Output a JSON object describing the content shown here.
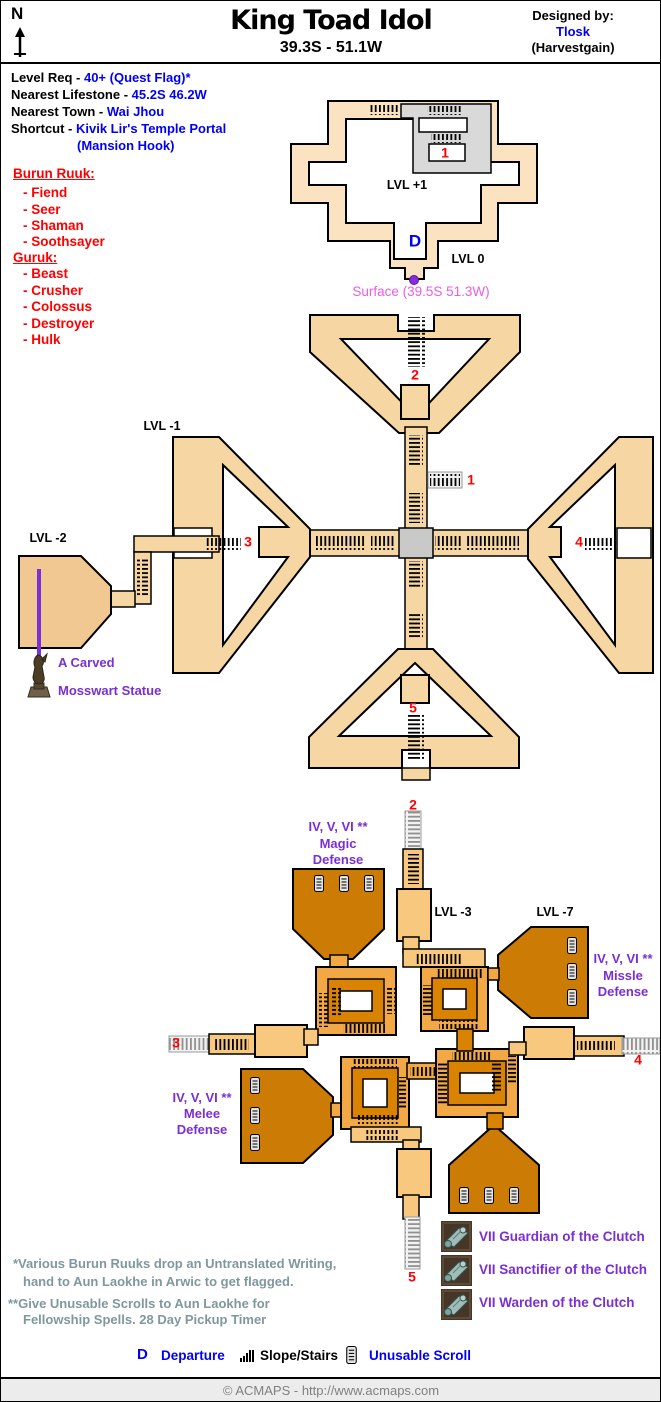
{
  "header": {
    "north": "N",
    "title": "King Toad Idol",
    "coords": "39.3S - 51.1W",
    "designed_by": "Designed by:",
    "designer": "Tlosk",
    "guild": "(Harvestgain)"
  },
  "info": {
    "lines": [
      {
        "label": "Level Req - ",
        "value": "40+ (Quest Flag)*"
      },
      {
        "label": "Nearest Lifestone - ",
        "value": "45.2S 46.2W"
      },
      {
        "label": "Nearest Town - ",
        "value": "Wai Jhou"
      },
      {
        "label": "Shortcut - ",
        "value": "Kivik Lir's Temple Portal"
      }
    ],
    "shortcut_line2": "(Mansion Hook)"
  },
  "creatures": {
    "burun": {
      "title": "Burun Ruuk:",
      "items": [
        "- Fiend",
        "- Seer",
        "- Shaman",
        "- Soothsayer"
      ]
    },
    "guruk": {
      "title": "Guruk:",
      "items": [
        "- Beast",
        "- Crusher",
        "- Colossus",
        "- Destroyer",
        "- Hulk"
      ]
    }
  },
  "levels": {
    "p1": "LVL +1",
    "zero": "LVL 0",
    "m1": "LVL -1",
    "m2": "LVL -2",
    "m3": "LVL -3",
    "m7": "LVL -7"
  },
  "markers": {
    "t1": "1",
    "m1": "1",
    "m2": "2",
    "m3": "3",
    "m4": "4",
    "m5": "5",
    "l2": "2",
    "l3": "3",
    "l4": "4",
    "l5": "5",
    "d": "D"
  },
  "surface": {
    "label": "Surface (39.5S 51.3W)"
  },
  "statue": {
    "line1": "A Carved",
    "line2": "Mosswart Statue"
  },
  "defense": {
    "magic": {
      "line1": "IV, V, VI **",
      "line2": "Magic",
      "line3": "Defense"
    },
    "missle": {
      "line1": "IV, V, VI **",
      "line2": "Missle",
      "line3": "Defense"
    },
    "melee": {
      "line1": "IV, V, VI **",
      "line2": "Melee",
      "line3": "Defense"
    }
  },
  "clutch": {
    "items": [
      {
        "label": "VII Guardian of the Clutch"
      },
      {
        "label": "VII Sanctifier of the Clutch"
      },
      {
        "label": "VII Warden of the Clutch"
      }
    ]
  },
  "footnotes": {
    "first_line1": "*Various Burun Ruuks drop an Untranslated Writing,",
    "first_line2": "hand to Aun Laokhe in Arwic to get flagged.",
    "second_line1": "**Give Unusable Scrolls to Aun Laokhe for",
    "second_line2": "Fellowship Spells.  28 Day Pickup Timer"
  },
  "legend": {
    "d": "D",
    "departure": "Departure",
    "stairs": "Slope/Stairs",
    "scroll": "Unusable Scroll"
  },
  "footer": {
    "copyright": "© ACMAPS - http://www.acmaps.com"
  },
  "icons": {
    "north_arrow": "up-arrow",
    "departure": "letter-D",
    "slope_stairs": "hatch-bars",
    "unusable_scroll": "scroll",
    "surface_portal": "purple-dot",
    "statue": "mosswart-statue",
    "clutch_scroll": "teal-scroll"
  },
  "colors": {
    "ring_light": "#FBE3C2",
    "corridor_tan": "#F6D7A4",
    "room_lvl2": "#F2C892",
    "lower_tan": "#F8C87E",
    "loop_light": "#F2A844",
    "loop_dark": "#D98300",
    "room_orange": "#CC7C04",
    "gray_corridor": "#D9D9D9",
    "cross_gray": "#C9C9C9",
    "marker_red": "#FF0000",
    "link_blue": "#0000F5",
    "purple": "#7B2FD2",
    "magenta": "#E85DE8",
    "footnote_gray": "#7E989E"
  }
}
